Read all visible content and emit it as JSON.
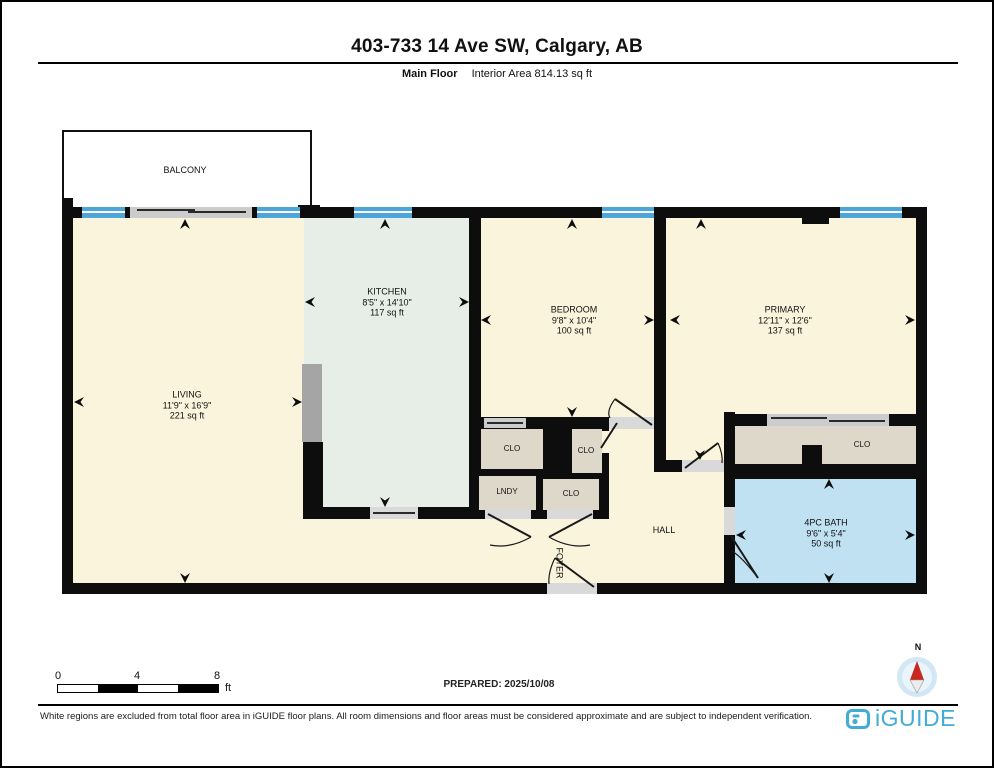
{
  "header": {
    "title": "403-733 14 Ave SW, Calgary, AB",
    "floor_label": "Main Floor",
    "area_label": "Interior Area 814.13 sq ft"
  },
  "rooms": {
    "balcony": {
      "name": "BALCONY"
    },
    "living": {
      "name": "LIVING",
      "dims": "11'9\" x 16'9\"",
      "area": "221 sq ft"
    },
    "kitchen": {
      "name": "KITCHEN",
      "dims": "8'5\" x 14'10\"",
      "area": "117 sq ft"
    },
    "bedroom": {
      "name": "BEDROOM",
      "dims": "9'8\" x 10'4\"",
      "area": "100 sq ft"
    },
    "primary": {
      "name": "PRIMARY",
      "dims": "12'11\" x 12'6\"",
      "area": "137 sq ft"
    },
    "bath": {
      "name": "4PC BATH",
      "dims": "9'6\" x 5'4\"",
      "area": "50 sq ft"
    },
    "closet1": {
      "name": "CLO"
    },
    "closet2": {
      "name": "CLO"
    },
    "closet3": {
      "name": "CLO"
    },
    "closet4": {
      "name": "CLO"
    },
    "laundry": {
      "name": "LNDY"
    },
    "hall": {
      "name": "HALL"
    },
    "foyer": {
      "name": "FOYER"
    }
  },
  "scale_bar": {
    "ticks": [
      "0",
      "4",
      "8"
    ],
    "unit": "ft"
  },
  "prepared_label": "PREPARED: 2025/10/08",
  "compass": {
    "north_label": "N"
  },
  "footer": {
    "disclaimer": "White regions are excluded from total floor area in iGUIDE floor plans. All room dimensions and floor areas must be considered approximate and are subject to independent verification.",
    "brand": "iGUIDE"
  },
  "colors": {
    "wall": "#0D0D0D",
    "room_fill": "#FBF4DC",
    "kitchen_fill": "#E7EEE8",
    "closet_fill": "#DED8CA",
    "bath_fill": "#BFE1F2",
    "window_blue": "#4DA6D9",
    "brand_blue": "#41ACD6",
    "compass_red": "#C8281E"
  }
}
